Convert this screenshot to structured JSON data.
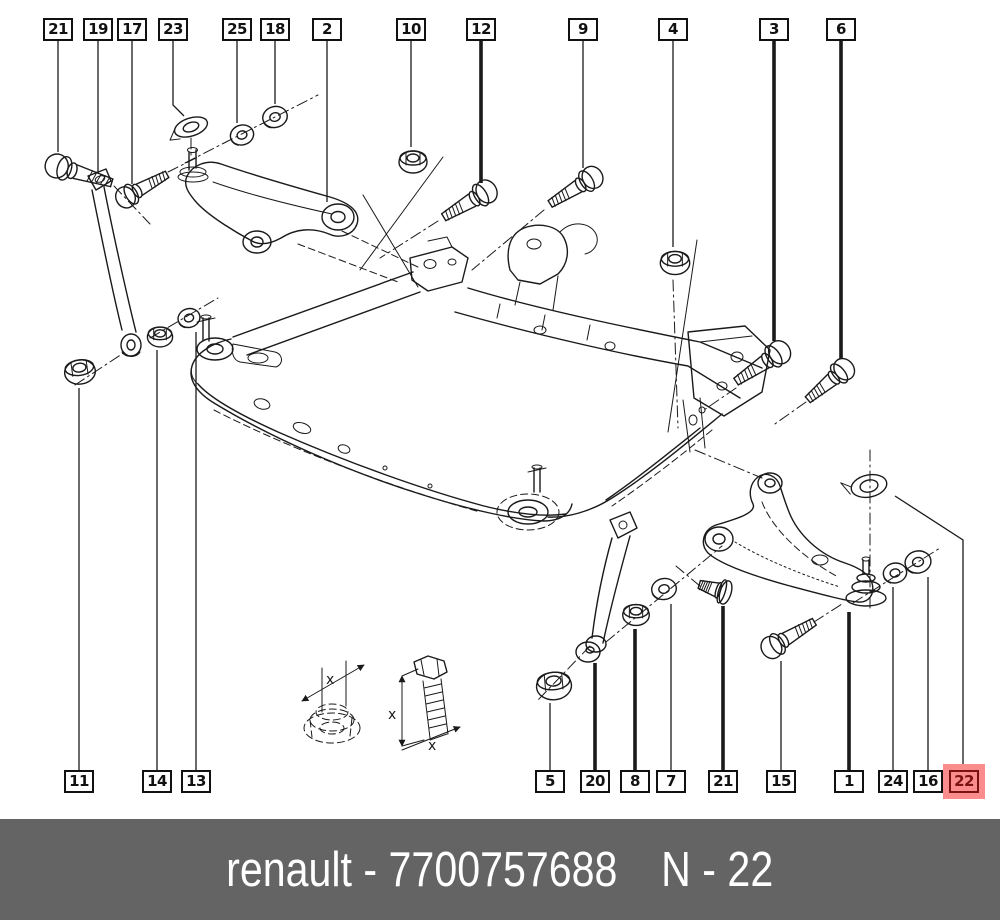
{
  "colors": {
    "line": "#1a1a1a",
    "highlight_bg": "#fb8c8c",
    "highlight_fg": "#7a1212",
    "footer_bg": "#646464",
    "footer_fg": "#ffffff"
  },
  "footer": {
    "label": "renault - 7700757688",
    "code": "N - 22"
  },
  "insets": {
    "dim_label": "x"
  },
  "callouts": {
    "top": [
      {
        "label": "21",
        "x": 58,
        "boxY": 18,
        "leader": [
          [
            58,
            40
          ],
          [
            58,
            152
          ]
        ],
        "bold": false
      },
      {
        "label": "19",
        "x": 98,
        "boxY": 18,
        "leader": [
          [
            98,
            40
          ],
          [
            98,
            174
          ]
        ],
        "bold": false
      },
      {
        "label": "17",
        "x": 132,
        "boxY": 18,
        "leader": [
          [
            132,
            40
          ],
          [
            132,
            184
          ]
        ],
        "bold": false
      },
      {
        "label": "23",
        "x": 173,
        "boxY": 18,
        "leader": [
          [
            173,
            40
          ],
          [
            173,
            105
          ],
          [
            184,
            116
          ]
        ],
        "bold": false
      },
      {
        "label": "25",
        "x": 237,
        "boxY": 18,
        "leader": [
          [
            237,
            40
          ],
          [
            237,
            123
          ]
        ],
        "bold": false
      },
      {
        "label": "18",
        "x": 275,
        "boxY": 18,
        "leader": [
          [
            275,
            40
          ],
          [
            275,
            104
          ]
        ],
        "bold": false
      },
      {
        "label": "2",
        "x": 327,
        "boxY": 18,
        "leader": [
          [
            327,
            40
          ],
          [
            327,
            202
          ]
        ],
        "bold": false
      },
      {
        "label": "10",
        "x": 411,
        "boxY": 18,
        "leader": [
          [
            411,
            40
          ],
          [
            411,
            147
          ]
        ],
        "bold": false
      },
      {
        "label": "12",
        "x": 481,
        "boxY": 18,
        "leader": [
          [
            481,
            40
          ],
          [
            481,
            183
          ]
        ],
        "bold": true
      },
      {
        "label": "9",
        "x": 583,
        "boxY": 18,
        "leader": [
          [
            583,
            40
          ],
          [
            583,
            168
          ]
        ],
        "bold": false
      },
      {
        "label": "4",
        "x": 673,
        "boxY": 18,
        "leader": [
          [
            673,
            40
          ],
          [
            673,
            247
          ]
        ],
        "bold": false
      },
      {
        "label": "3",
        "x": 774,
        "boxY": 18,
        "leader": [
          [
            774,
            40
          ],
          [
            774,
            341
          ]
        ],
        "bold": true
      },
      {
        "label": "6",
        "x": 841,
        "boxY": 18,
        "leader": [
          [
            841,
            40
          ],
          [
            841,
            359
          ]
        ],
        "bold": true
      }
    ],
    "bottom": [
      {
        "label": "11",
        "x": 79,
        "boxY": 770,
        "leader": [
          [
            79,
            388
          ],
          [
            79,
            770
          ]
        ],
        "bold": false
      },
      {
        "label": "14",
        "x": 157,
        "boxY": 770,
        "leader": [
          [
            157,
            350
          ],
          [
            157,
            770
          ]
        ],
        "bold": false
      },
      {
        "label": "13",
        "x": 196,
        "boxY": 770,
        "leader": [
          [
            196,
            332
          ],
          [
            196,
            770
          ]
        ],
        "bold": false
      },
      {
        "label": "5",
        "x": 550,
        "boxY": 770,
        "leader": [
          [
            550,
            703
          ],
          [
            550,
            770
          ]
        ],
        "bold": false
      },
      {
        "label": "20",
        "x": 595,
        "boxY": 770,
        "leader": [
          [
            595,
            663
          ],
          [
            595,
            770
          ]
        ],
        "bold": true
      },
      {
        "label": "8",
        "x": 635,
        "boxY": 770,
        "leader": [
          [
            635,
            629
          ],
          [
            635,
            770
          ]
        ],
        "bold": true
      },
      {
        "label": "7",
        "x": 671,
        "boxY": 770,
        "leader": [
          [
            671,
            604
          ],
          [
            671,
            770
          ]
        ],
        "bold": false
      },
      {
        "label": "21",
        "x": 723,
        "boxY": 770,
        "leader": [
          [
            723,
            606
          ],
          [
            723,
            770
          ]
        ],
        "bold": true
      },
      {
        "label": "15",
        "x": 781,
        "boxY": 770,
        "leader": [
          [
            781,
            661
          ],
          [
            781,
            770
          ]
        ],
        "bold": false
      },
      {
        "label": "1",
        "x": 849,
        "boxY": 770,
        "leader": [
          [
            849,
            612
          ],
          [
            849,
            770
          ]
        ],
        "bold": true
      },
      {
        "label": "24",
        "x": 893,
        "boxY": 770,
        "leader": [
          [
            893,
            587
          ],
          [
            893,
            770
          ]
        ],
        "bold": false
      },
      {
        "label": "16",
        "x": 928,
        "boxY": 770,
        "leader": [
          [
            928,
            577
          ],
          [
            928,
            770
          ]
        ],
        "bold": false
      },
      {
        "label": "22",
        "x": 964,
        "boxY": 770,
        "leader": [
          [
            895,
            496
          ],
          [
            963,
            540
          ],
          [
            963,
            770
          ]
        ],
        "bold": false,
        "highlight": true
      }
    ]
  }
}
